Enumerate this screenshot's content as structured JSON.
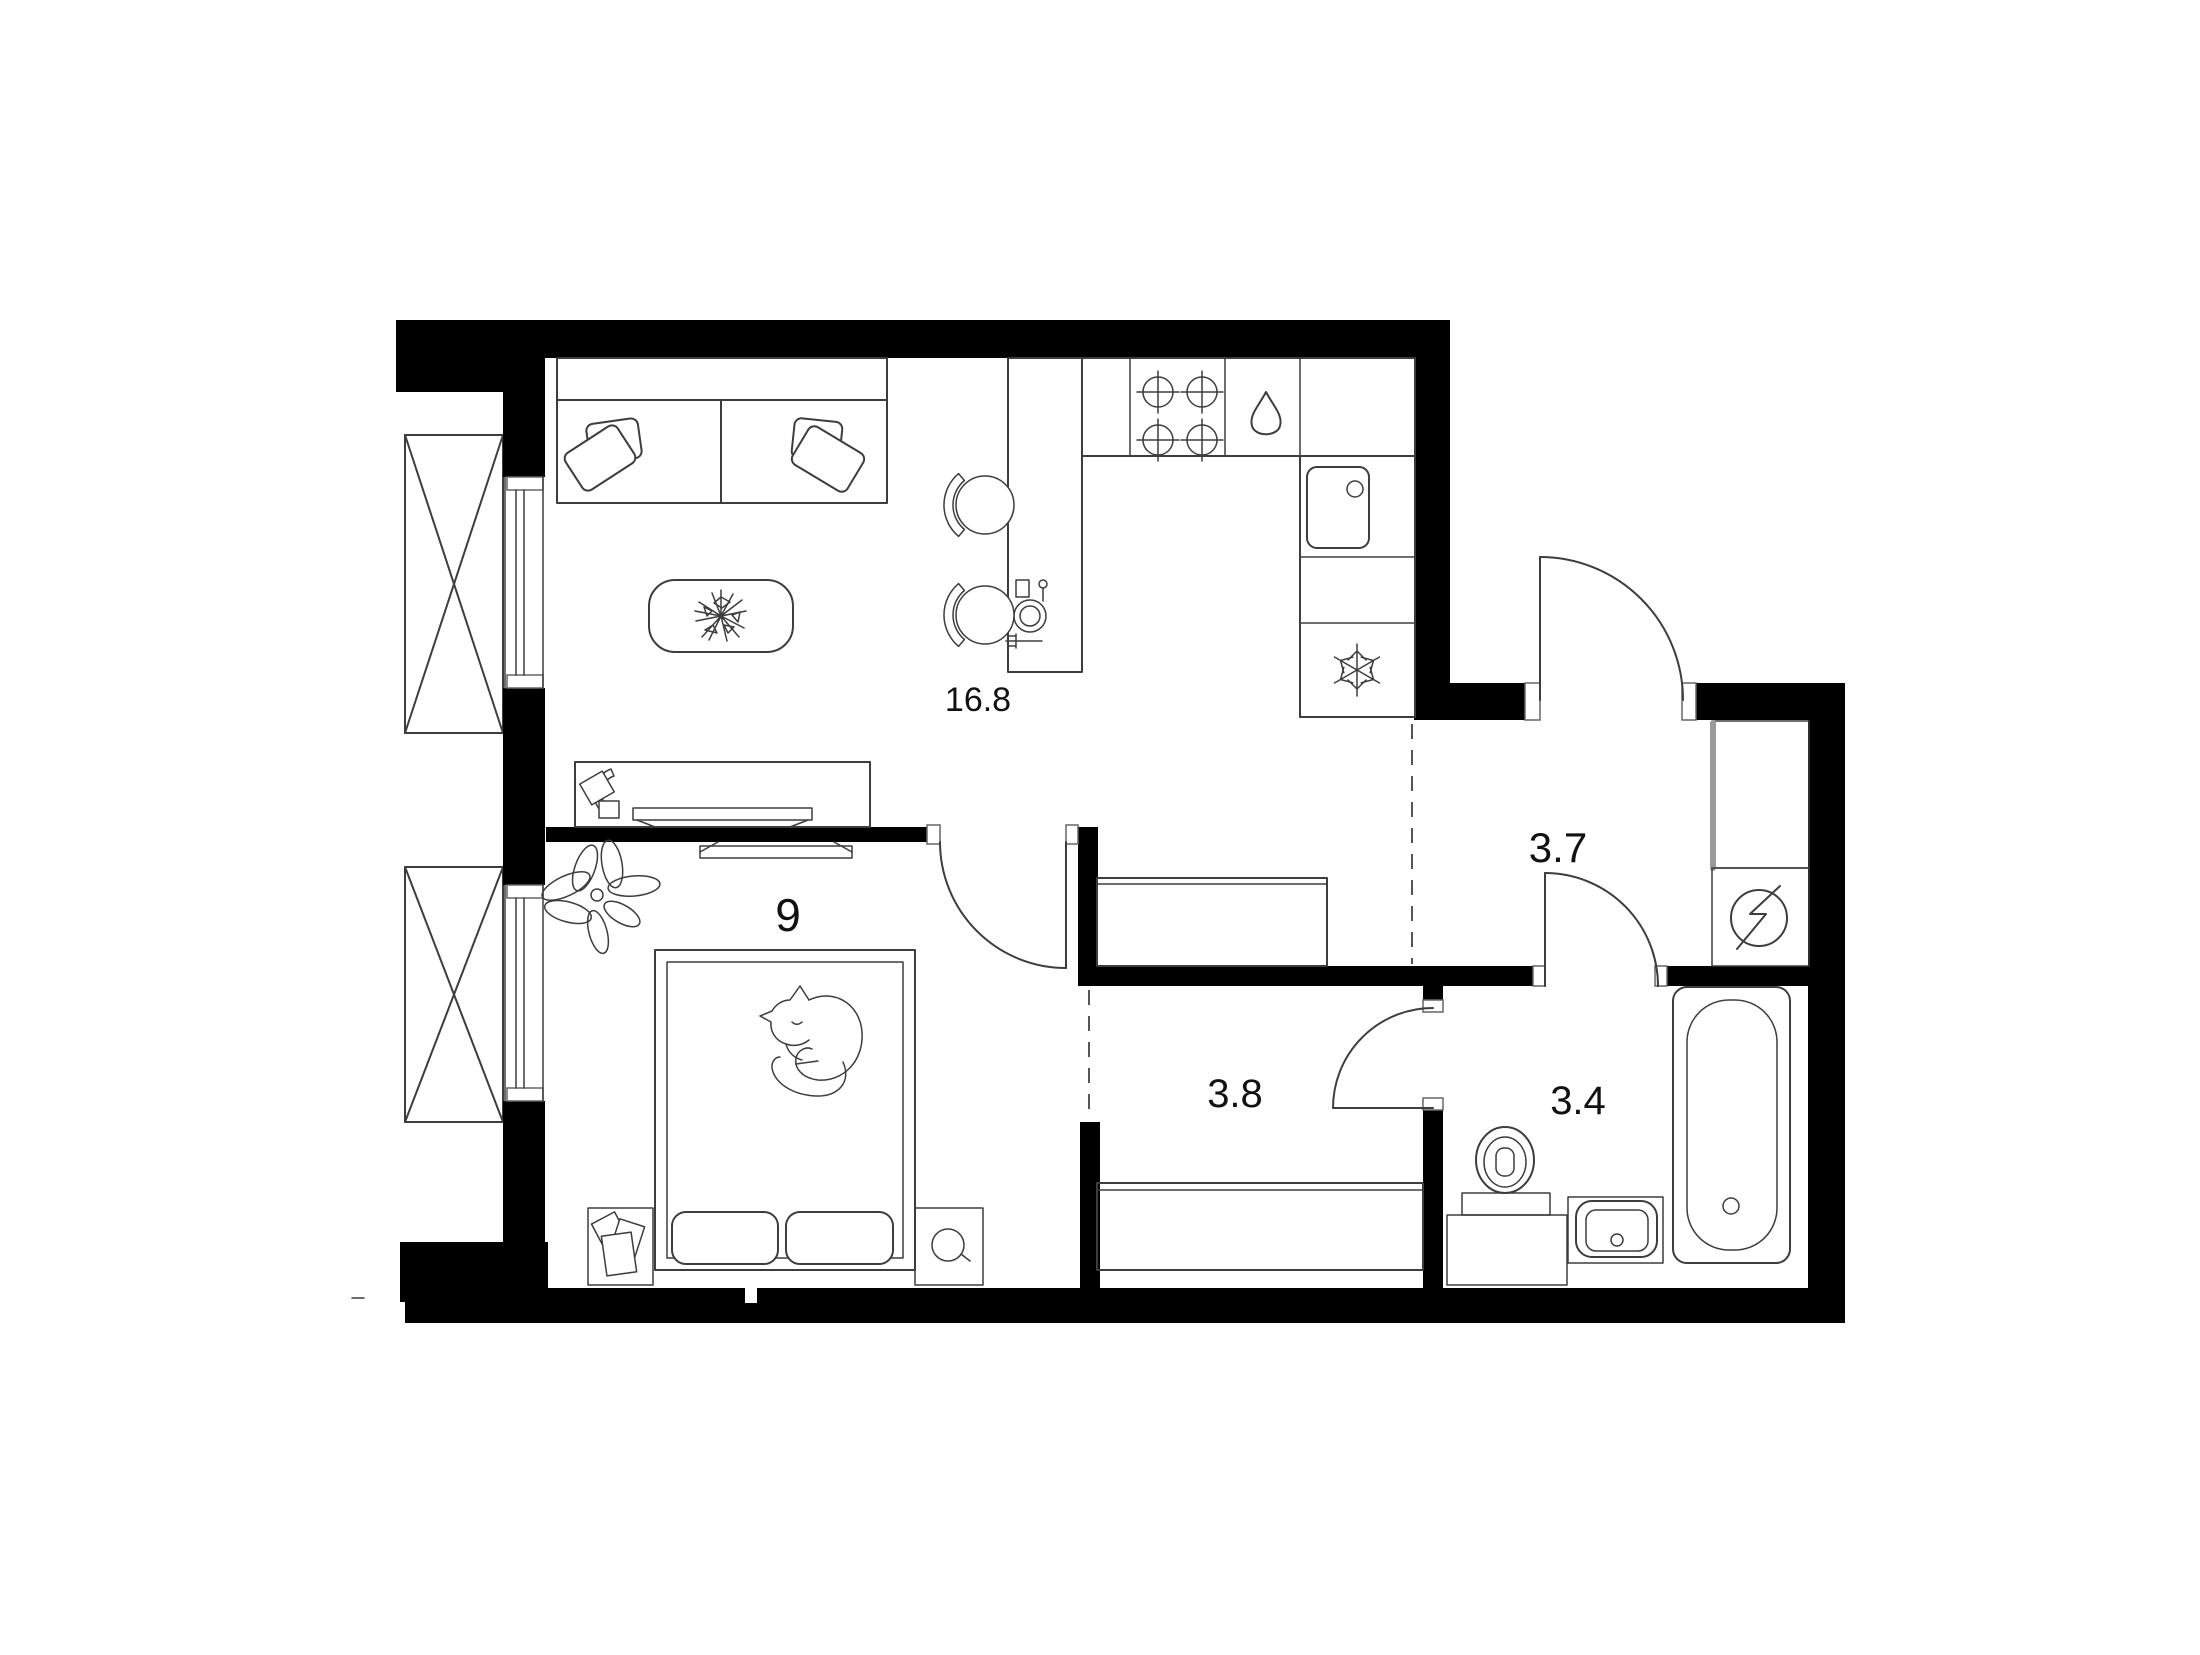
{
  "plan": {
    "type": "apartment-floor-plan",
    "units": "m2",
    "rooms": [
      {
        "id": "living-kitchen",
        "area": "16.8"
      },
      {
        "id": "bedroom",
        "area": "9"
      },
      {
        "id": "hall",
        "area": "3.7"
      },
      {
        "id": "corridor",
        "area": "3.8"
      },
      {
        "id": "bathroom",
        "area": "3.4"
      }
    ],
    "icons": [
      "stove-burners-icon",
      "water-drop-icon",
      "fridge-snowflake-icon",
      "electric-panel-icon",
      "sink-icon",
      "bathtub-icon",
      "toilet-icon",
      "washbasin-icon",
      "plant-icon",
      "cat-icon",
      "flower-icon"
    ],
    "palette": {
      "wall": "#000000",
      "line": "#3d3d3d",
      "label": "#111111",
      "dashed": "#555555",
      "closet_edge": "#9a9a9a",
      "background": "#ffffff"
    }
  }
}
